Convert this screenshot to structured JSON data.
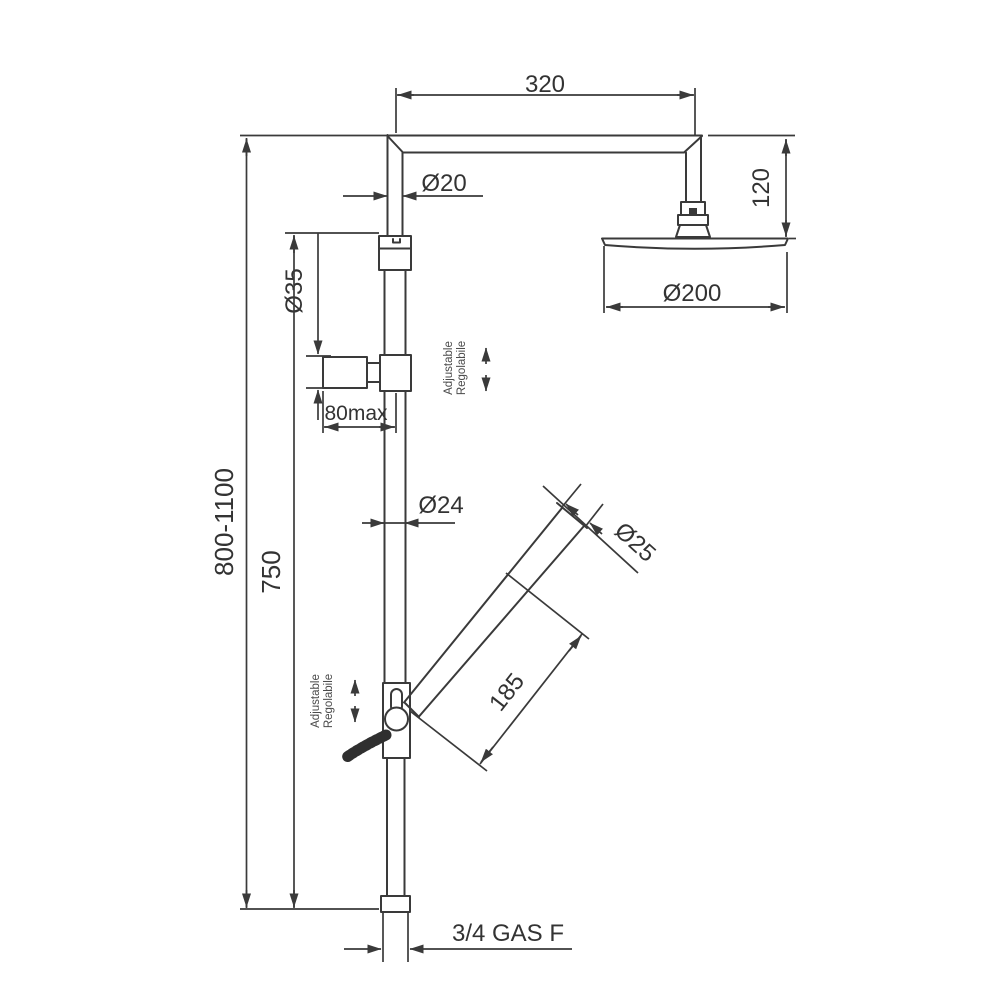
{
  "drawing": {
    "dimensions": {
      "arm_length": "320",
      "arm_diameter": "Ø20",
      "head_drop_height": "120",
      "head_diameter": "Ø200",
      "bracket_diameter": "Ø35",
      "wall_clearance": "80max",
      "column_diameter": "Ø24",
      "handset_diameter": "Ø25",
      "handset_length": "185",
      "lower_column_height": "750",
      "overall_height": "800-1100",
      "inlet_connection": "3/4 GAS F"
    },
    "notes": {
      "upper_adjustable_en": "Adjustable",
      "upper_adjustable_it": "Regolabile",
      "lower_adjustable_en": "Adjustable",
      "lower_adjustable_it": "Regolabile"
    },
    "colors": {
      "line": "#3a3a3a",
      "text": "#333333",
      "background": "#ffffff"
    }
  }
}
